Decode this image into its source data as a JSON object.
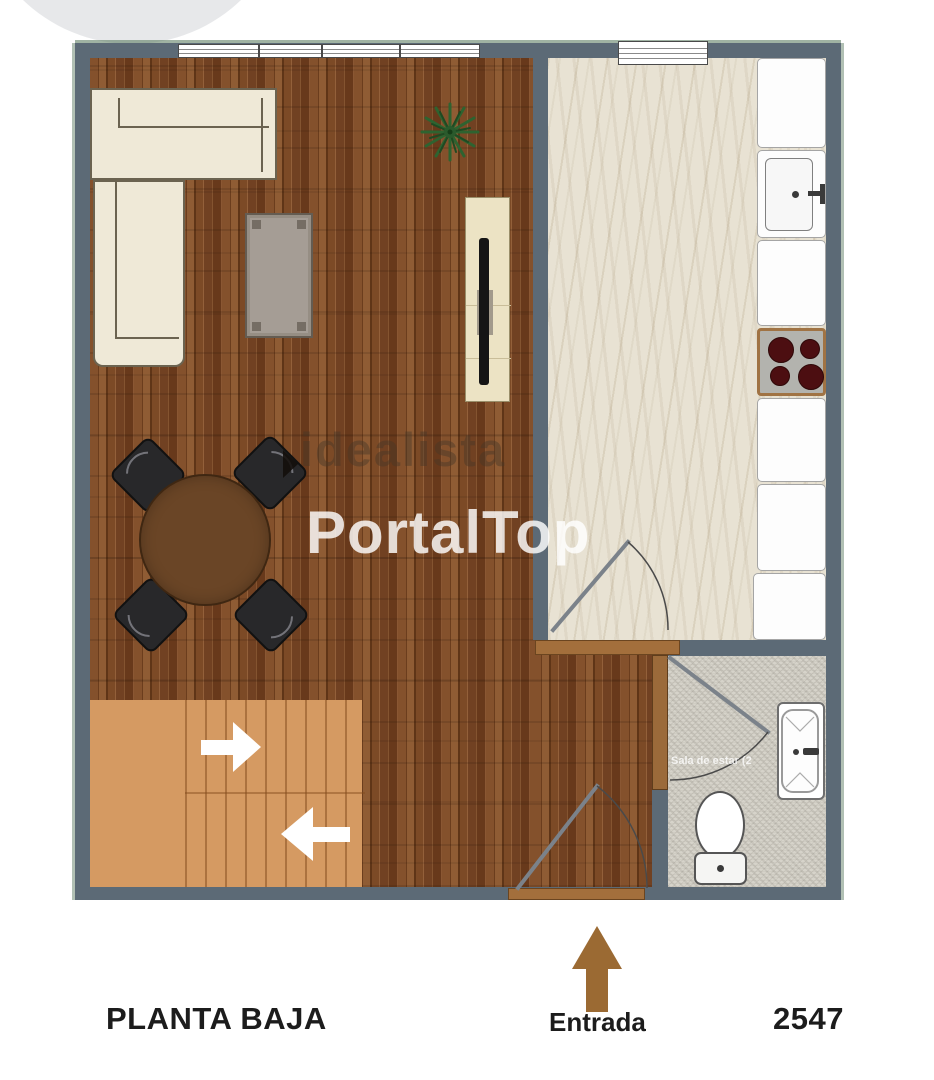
{
  "plan": {
    "floor_label": "PLANTA BAJA",
    "entrance_label": "Entrada",
    "plan_number": "2547",
    "bathroom_room_label": "Sala de estar (2",
    "watermark_brand": "idealista",
    "watermark_portal": "PortalTop"
  },
  "colors": {
    "wall": "#5c6a76",
    "wood_floor": "#7a4a26",
    "stairs": "#d59a62",
    "kitchen_floor": "#e8e2d3",
    "bathroom_floor": "#d6d3ca",
    "entrance_arrow_brown": "#9b6a33",
    "door_wood": "#a36f3c",
    "sofa_cream": "#efe9d7",
    "table_brown": "#6a4526",
    "stove_burner_red": "#4c0e11"
  },
  "icons": {
    "entrance_arrow": "arrow-up",
    "stairs_arrow_up": "arrow-right",
    "stairs_arrow_down": "arrow-left",
    "plant": "potted-plant"
  }
}
